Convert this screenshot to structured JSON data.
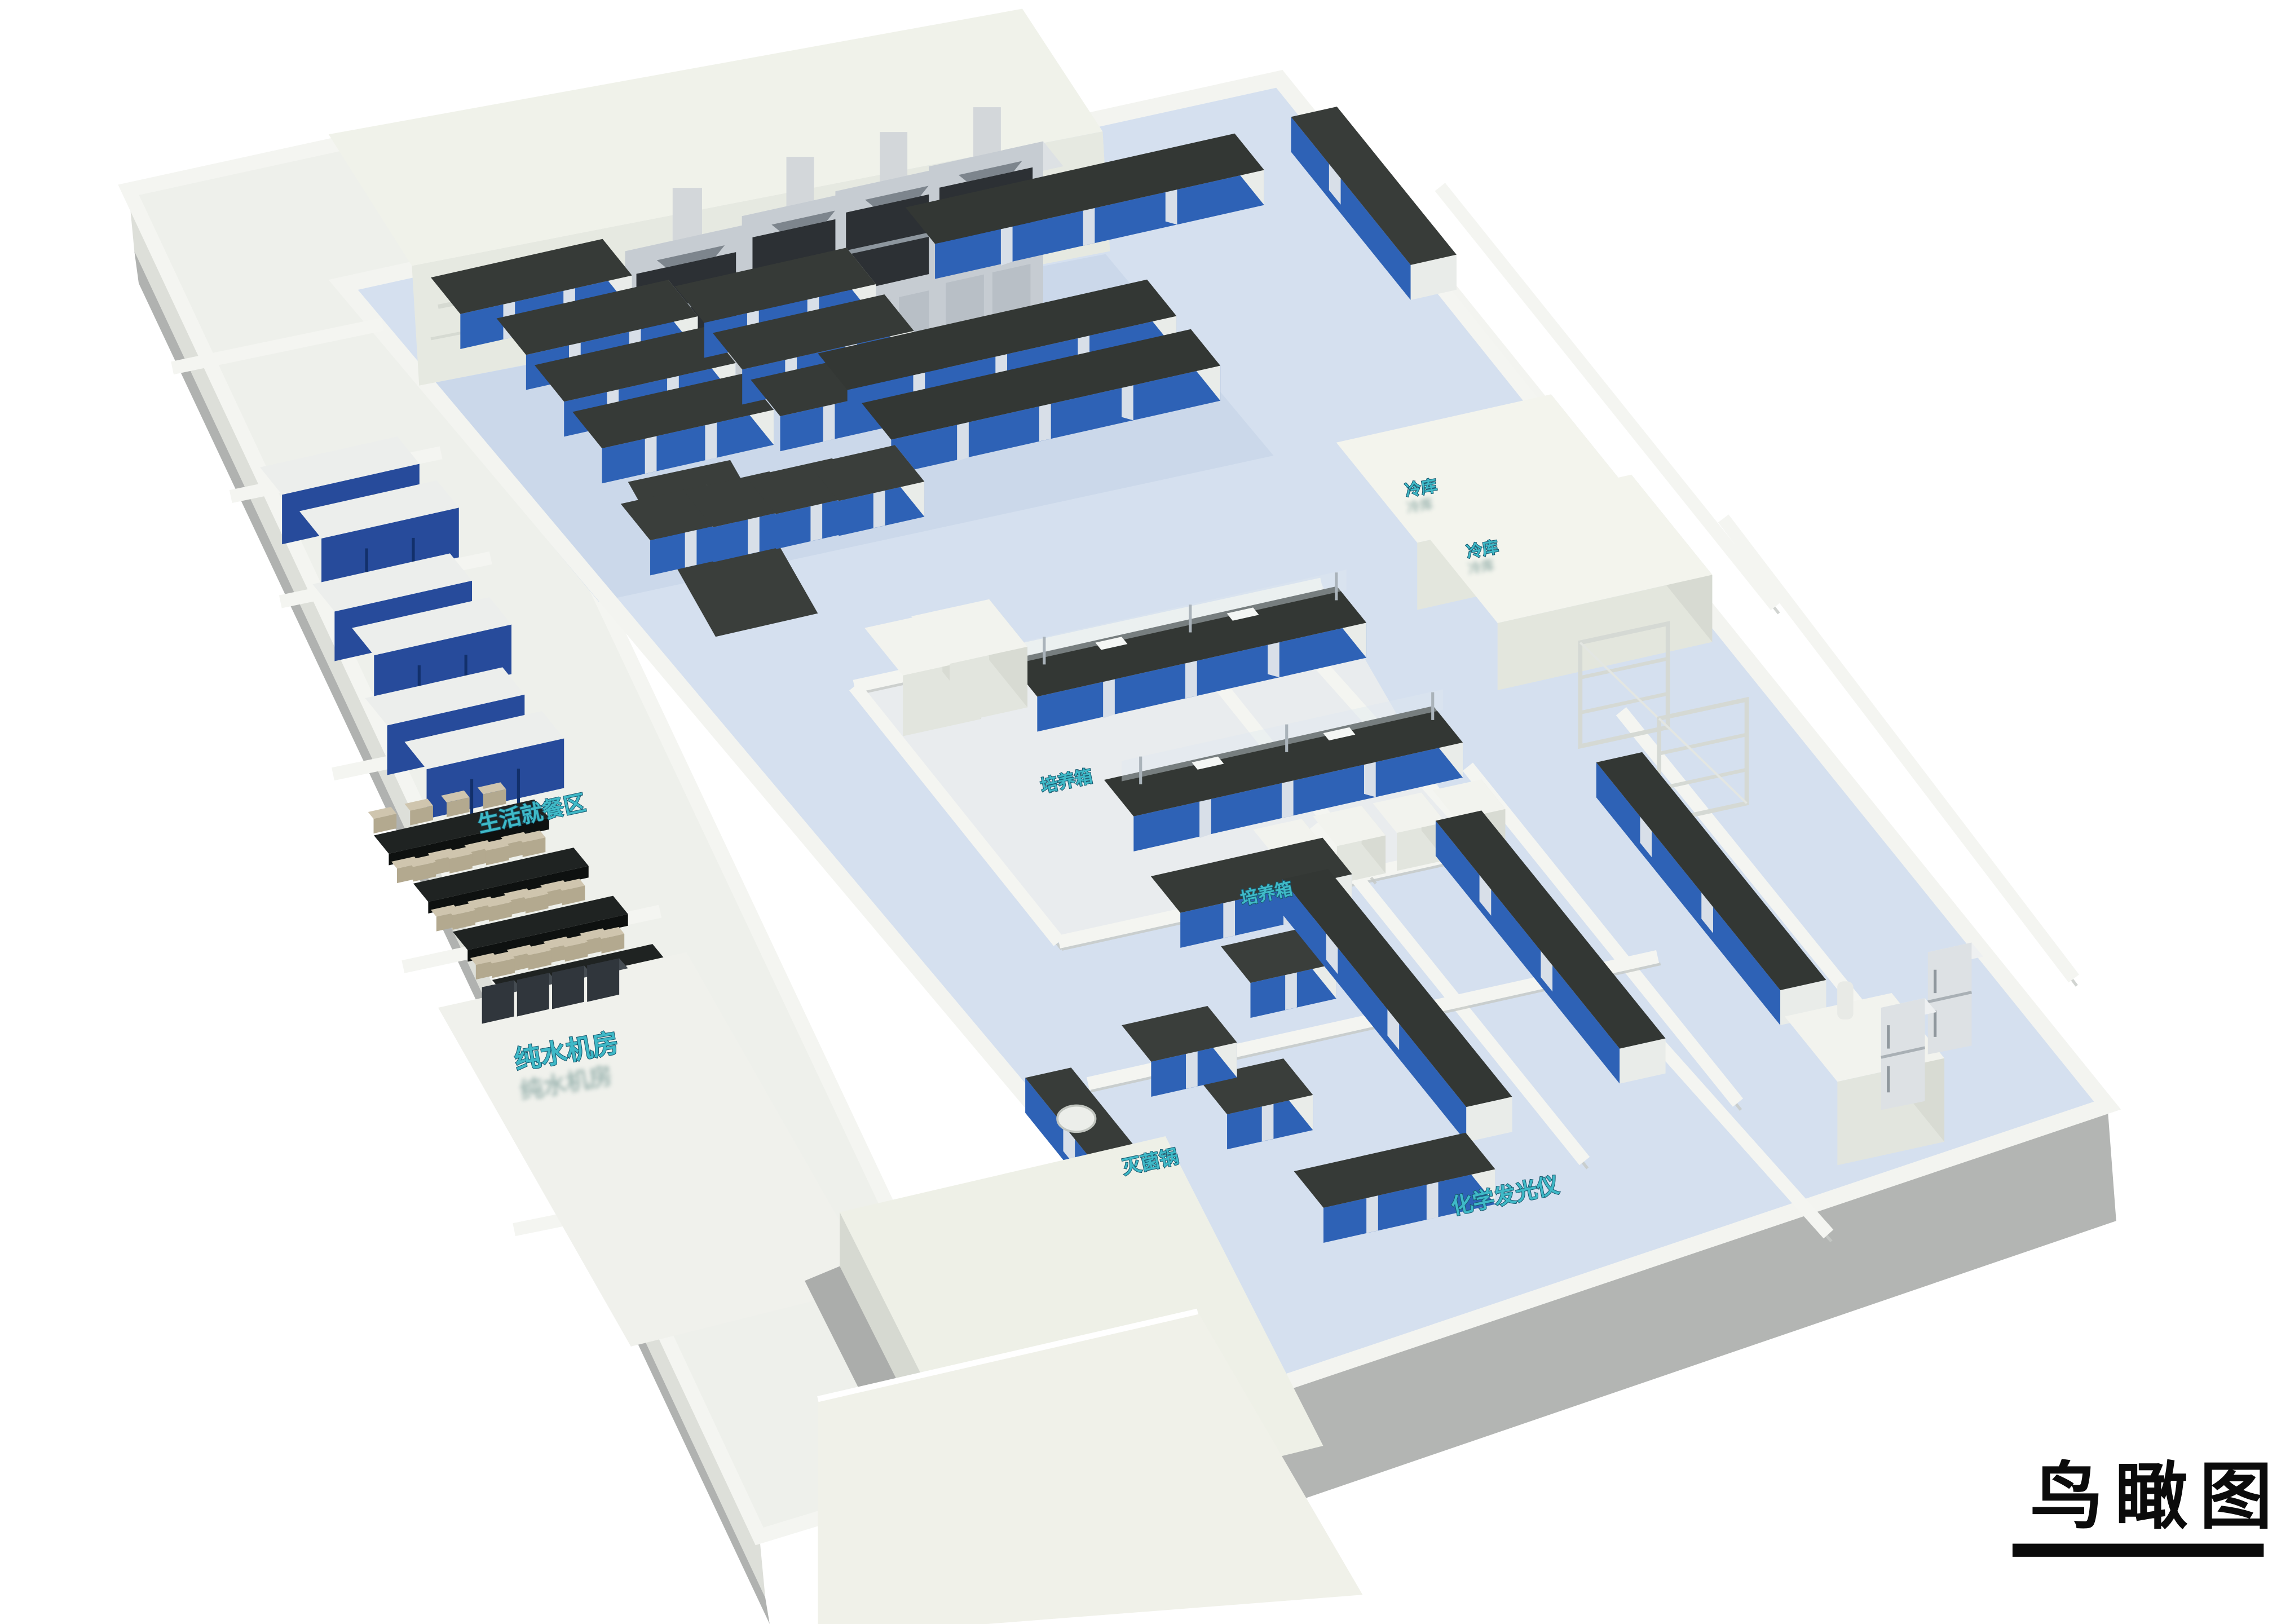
{
  "scene": {
    "background": "#ffffff",
    "view": "bird's-eye 3D rendering of a laboratory floor"
  },
  "title": {
    "text": "鸟瞰图"
  },
  "labels": {
    "dining": {
      "text": "生活就餐区"
    },
    "pure_water": {
      "text": "纯水机房"
    },
    "incubator_a": {
      "text": "培养箱"
    },
    "incubator_b": {
      "text": "培养箱"
    },
    "autoclave": {
      "text": "灭菌锅"
    },
    "chemiluminescence": {
      "text": "化学发光仪"
    },
    "cold_room_a": {
      "text": "冷库"
    },
    "cold_room_b": {
      "text": "冷库"
    }
  },
  "palette": {
    "label_teal": "#3fb9c7",
    "label_outline": "#17586e",
    "bench_top": "#3a3e3b",
    "bench_blue": "#2e62b6",
    "locker_blue": "#274b9b",
    "floor_blue": "#d5e0ef",
    "wall_white": "#f3f4f0",
    "roof_ivory": "#eef0e8",
    "plinth_gray": "#b3b5b3",
    "chair_beige": "#cfc5ae",
    "title_black": "#0b0b0b"
  }
}
